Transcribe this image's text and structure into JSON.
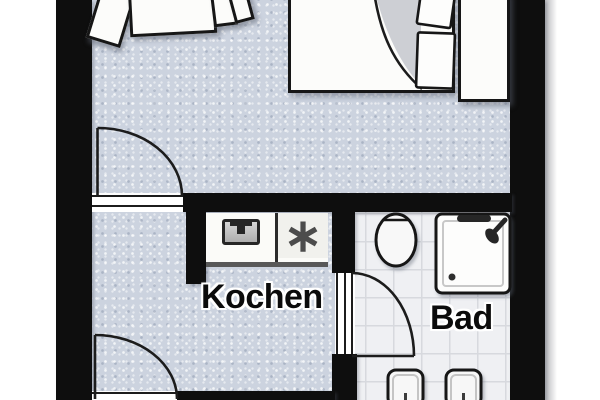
{
  "plan": {
    "rooms": {
      "kitchen": {
        "label": "Kochen"
      },
      "bathroom": {
        "label": "Bad"
      }
    },
    "symbols": {
      "sink": "∗"
    },
    "colors": {
      "wall": "#0e0e0e",
      "floor": "#ccd3df",
      "bath_floor": "#eff0f3",
      "bath_grid": "#d7d9de",
      "furniture": "#fcfcfa",
      "outline": "#161616"
    }
  }
}
